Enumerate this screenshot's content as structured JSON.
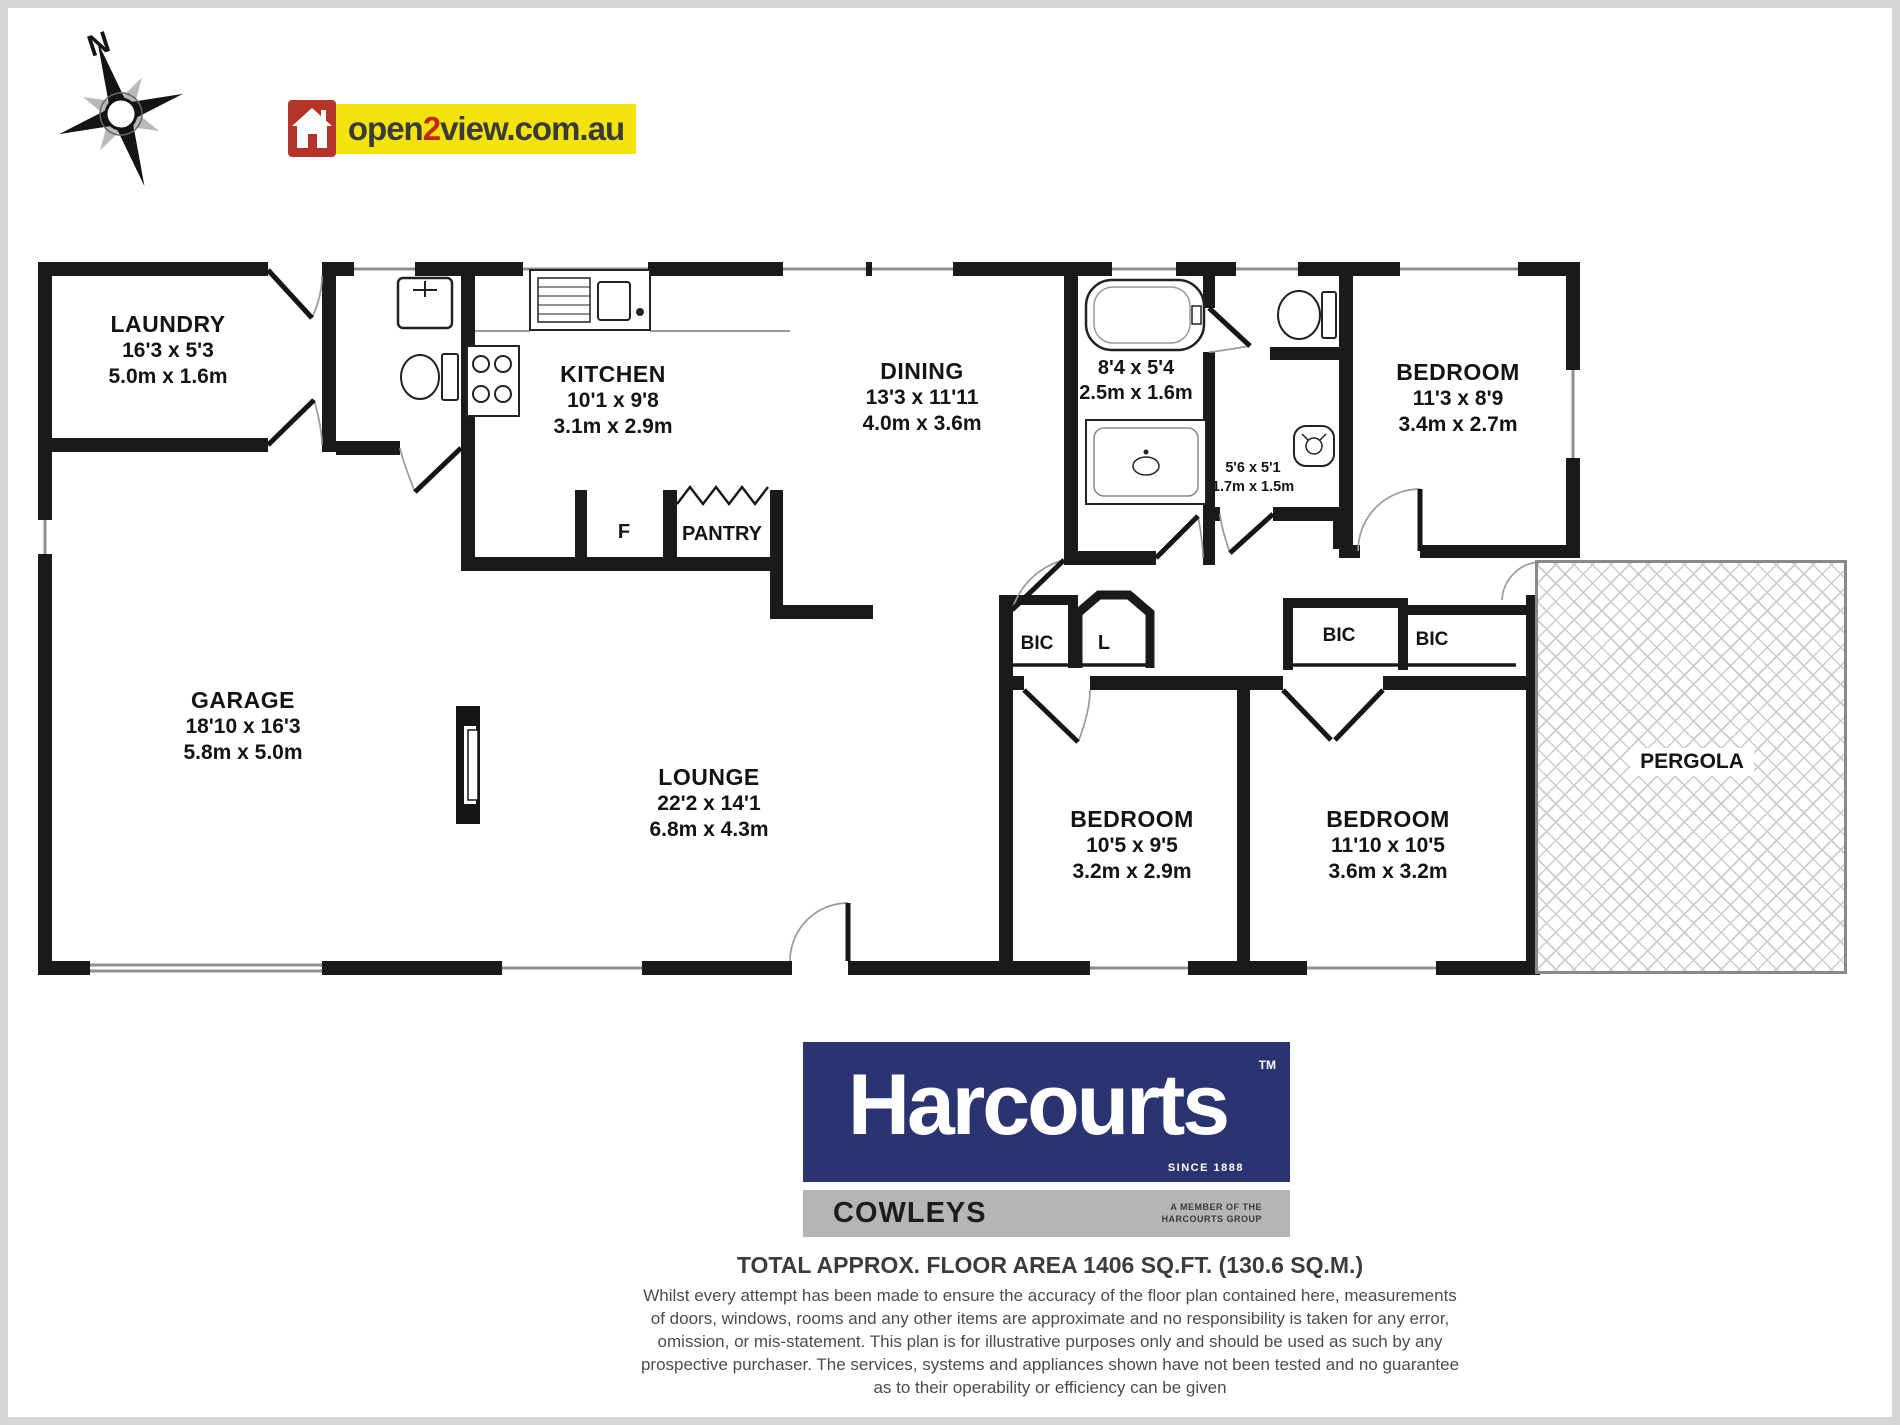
{
  "compass": {
    "north": "N"
  },
  "logo": {
    "open": "open",
    "two": "2",
    "rest": "view.com.au"
  },
  "rooms": {
    "laundry": {
      "name": "LAUNDRY",
      "imperial": "16'3 x 5'3",
      "metric": "5.0m x 1.6m"
    },
    "kitchen": {
      "name": "KITCHEN",
      "imperial": "10'1 x 9'8",
      "metric": "3.1m x 2.9m"
    },
    "dining": {
      "name": "DINING",
      "imperial": "13'3 x 11'11",
      "metric": "4.0m x 3.6m"
    },
    "bathroom": {
      "imperial": "8'4 x 5'4",
      "metric": "2.5m x 1.6m"
    },
    "toilet": {
      "imperial": "5'6 x 5'1",
      "metric": "1.7m x 1.5m"
    },
    "bedroom1": {
      "name": "BEDROOM",
      "imperial": "11'3 x 8'9",
      "metric": "3.4m x 2.7m"
    },
    "garage": {
      "name": "GARAGE",
      "imperial": "18'10 x 16'3",
      "metric": "5.8m x 5.0m"
    },
    "lounge": {
      "name": "LOUNGE",
      "imperial": "22'2 x 14'1",
      "metric": "6.8m x 4.3m"
    },
    "bedroom2": {
      "name": "BEDROOM",
      "imperial": "10'5 x 9'5",
      "metric": "3.2m x 2.9m"
    },
    "bedroom3": {
      "name": "BEDROOM",
      "imperial": "11'10 x 10'5",
      "metric": "3.6m x 3.2m"
    },
    "pergola": {
      "name": "PERGOLA"
    }
  },
  "labels": {
    "fridge": "F",
    "pantry": "PANTRY",
    "bic": "BIC",
    "linen": "L"
  },
  "branding": {
    "name": "Harcourts",
    "tm": "TM",
    "since": "SINCE 1888",
    "office": "COWLEYS",
    "member_line1": "A MEMBER OF THE",
    "member_line2": "HARCOURTS GROUP"
  },
  "footer": {
    "area": "TOTAL APPROX. FLOOR AREA 1406 SQ.FT. (130.6 SQ.M.)",
    "disclaimer": [
      "Whilst every attempt has been made to ensure the accuracy of the floor plan contained here, measurements",
      "of doors, windows, rooms and any other items are approximate and no responsibility is taken for any error,",
      "omission, or mis-statement. This plan is for illustrative purposes only and should be used as such by any",
      "prospective purchaser. The services, systems and appliances shown have not been tested and no guarantee",
      "as to their operability or efficiency can be given"
    ]
  },
  "colors": {
    "wall": "#1a1a1a",
    "logo_red": "#b5342a",
    "logo_yellow": "#f2e30c",
    "harcourts_navy": "#2a3470",
    "harcourts_gray": "#b5b5b5"
  }
}
